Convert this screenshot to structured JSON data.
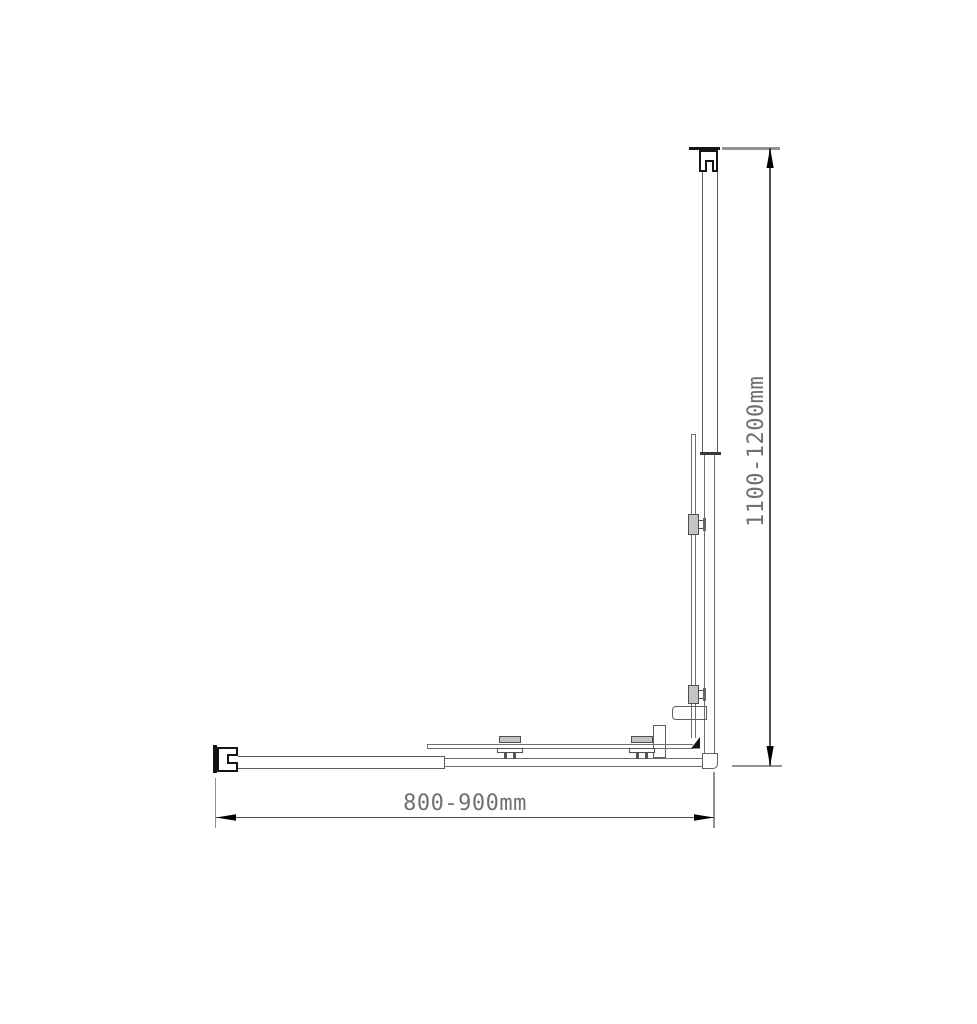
{
  "drawing": {
    "kind": "technical dimension line drawing",
    "horizontal_dimension": {
      "label": "800-900mm"
    },
    "vertical_dimension": {
      "label": "1100-1200mm"
    },
    "colors": {
      "background": "#ffffff",
      "bracket": "#141414",
      "profile_line": "#5a5a5a",
      "glass_line": "#707070",
      "clamp_fill": "#c4c4c4",
      "dimension_line": "#4f4f4f",
      "extension_line": "#929292",
      "label_text": "#707070",
      "arrow": "#000000"
    }
  }
}
